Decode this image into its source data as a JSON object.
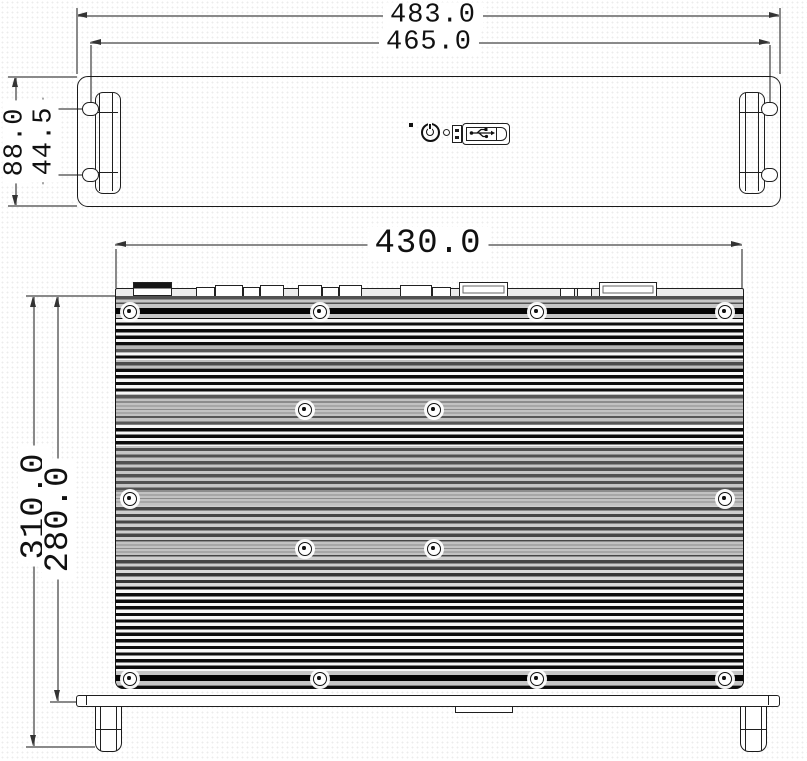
{
  "drawing_type": "mechanical dimension drawing, 2-view (front panel + top heatsink view)",
  "colors": {
    "outline": "#1a1a1a",
    "dimension_line": "#8a8a8a",
    "text": "#111111",
    "fin_dark": "#0d0d0d",
    "rail_gray": "#c2c2c2"
  },
  "front_view": {
    "dims": {
      "overall_width": "483.0",
      "mount_slot_spacing_h": "465.0",
      "overall_height": "88.0",
      "slot_spacing_v": "44.5"
    },
    "icons": {
      "power": "power-button",
      "usb": "usb-port",
      "led": "led-indicator",
      "aux_connector": "mini-connector"
    }
  },
  "top_view": {
    "dims": {
      "body_width": "430.0",
      "overall_depth": "310.0",
      "body_depth": "280.0"
    },
    "screws": [
      {
        "y": 311,
        "xs": [
          129,
          319,
          536,
          724
        ]
      },
      {
        "y": 409,
        "xs": [
          304,
          433
        ]
      },
      {
        "y": 498,
        "xs": [
          129,
          724
        ]
      },
      {
        "y": 548,
        "xs": [
          304,
          433
        ]
      },
      {
        "y": 678,
        "xs": [
          129,
          319,
          536,
          724
        ]
      }
    ],
    "rear_connectors": [
      {
        "x": 133,
        "y": 282,
        "w": 37,
        "h": 12,
        "s": "dark"
      },
      {
        "x": 196,
        "y": 287,
        "w": 17,
        "h": 8,
        "s": "plain"
      },
      {
        "x": 215,
        "y": 285,
        "w": 26,
        "h": 10,
        "s": "plain"
      },
      {
        "x": 243,
        "y": 287,
        "w": 15,
        "h": 8,
        "s": "plain"
      },
      {
        "x": 260,
        "y": 285,
        "w": 22,
        "h": 10,
        "s": "plain"
      },
      {
        "x": 298,
        "y": 285,
        "w": 22,
        "h": 10,
        "s": "plain"
      },
      {
        "x": 322,
        "y": 287,
        "w": 15,
        "h": 8,
        "s": "plain"
      },
      {
        "x": 339,
        "y": 285,
        "w": 21,
        "h": 10,
        "s": "plain"
      },
      {
        "x": 400,
        "y": 285,
        "w": 30,
        "h": 10,
        "s": "plain"
      },
      {
        "x": 432,
        "y": 287,
        "w": 17,
        "h": 8,
        "s": "plain"
      },
      {
        "x": 459,
        "y": 282,
        "w": 47,
        "h": 13,
        "s": "inner"
      },
      {
        "x": 560,
        "y": 288,
        "w": 13,
        "h": 7,
        "s": "plain"
      },
      {
        "x": 577,
        "y": 288,
        "w": 13,
        "h": 7,
        "s": "plain"
      },
      {
        "x": 599,
        "y": 282,
        "w": 56,
        "h": 13,
        "s": "inner"
      }
    ]
  }
}
